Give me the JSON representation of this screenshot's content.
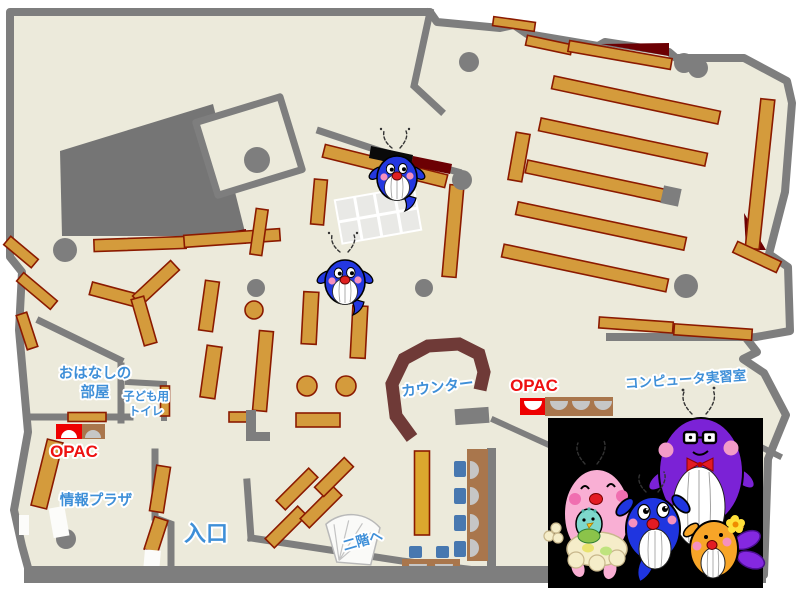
{
  "map": {
    "labels": {
      "storytelling_room_line1": "おはなしの",
      "storytelling_room_line2": "部屋",
      "kids_toilet_line1": "子ども用",
      "kids_toilet_line2": "トイレ",
      "opac_left": "OPAC",
      "opac_right": "OPAC",
      "info_plaza": "情報プラザ",
      "entrance": "入口",
      "counter": "カウンター",
      "to_second_floor": "二階へ",
      "computer_room": "コンピュータ実習室"
    },
    "colors": {
      "floor": "#ECEADB",
      "wall_gray": "#7E7E7E",
      "bookshelf": "#D49B3C",
      "bookshelf_border": "#8B1A00",
      "dark_red_area": "#6C0003",
      "counter_brown": "#6F3A37",
      "label_blue": "#3E8FD8",
      "opac_red": "#EE1111",
      "chair_blue": "#4878B0",
      "table_brown": "#A9764C",
      "seat_gray": "#C6C6C6",
      "panel_black": "#000000",
      "whale_blue": "#2438E0",
      "dad_purple": "#7B22D6",
      "mom_pink": "#F9AFD4",
      "kid_orange": "#F7A528",
      "baby_teal": "#7ED8CC"
    }
  }
}
